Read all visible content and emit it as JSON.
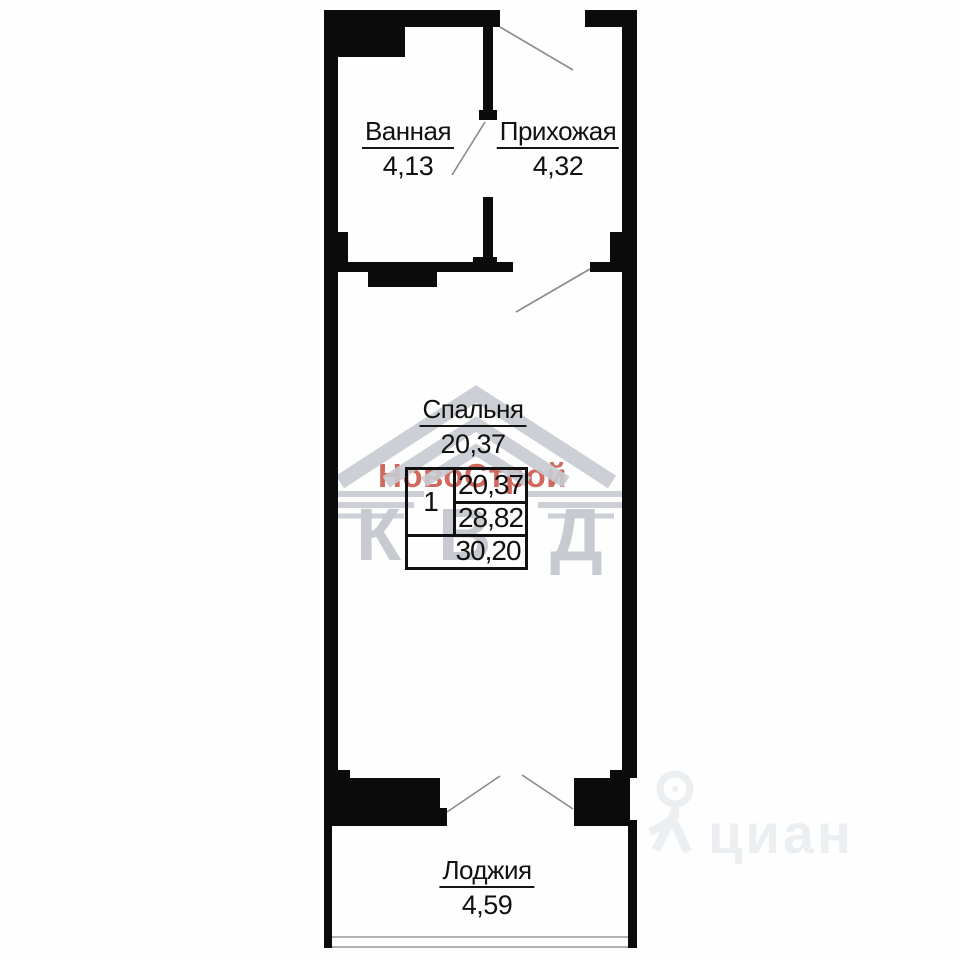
{
  "floor_plan": {
    "rooms": {
      "bathroom": {
        "name": "Ванная",
        "area": "4,13"
      },
      "hallway": {
        "name": "Прихожая",
        "area": "4,32"
      },
      "bedroom": {
        "name": "Спальня",
        "area": "20,37"
      },
      "loggia": {
        "name": "Лоджия",
        "area": "4,59"
      }
    },
    "summary_table": {
      "rooms_count": "1",
      "living_area": "20,37",
      "area_without_loggia": "28,82",
      "total_area": "30,20"
    }
  },
  "watermarks": {
    "developer_name": "НовоСтрой",
    "developer_logo_letters": [
      "К",
      "В",
      "Д"
    ],
    "listing_site_name": "циан"
  },
  "colors": {
    "walls": "#0b0b0b",
    "developer_name_red": "#d05f55",
    "developer_logo_gray": "#c7cbd1",
    "cian_watermark_gray": "#eceff1",
    "door_swing_line": "#8a8a8a",
    "loggia_glazing_line": "#b0b4b6"
  }
}
